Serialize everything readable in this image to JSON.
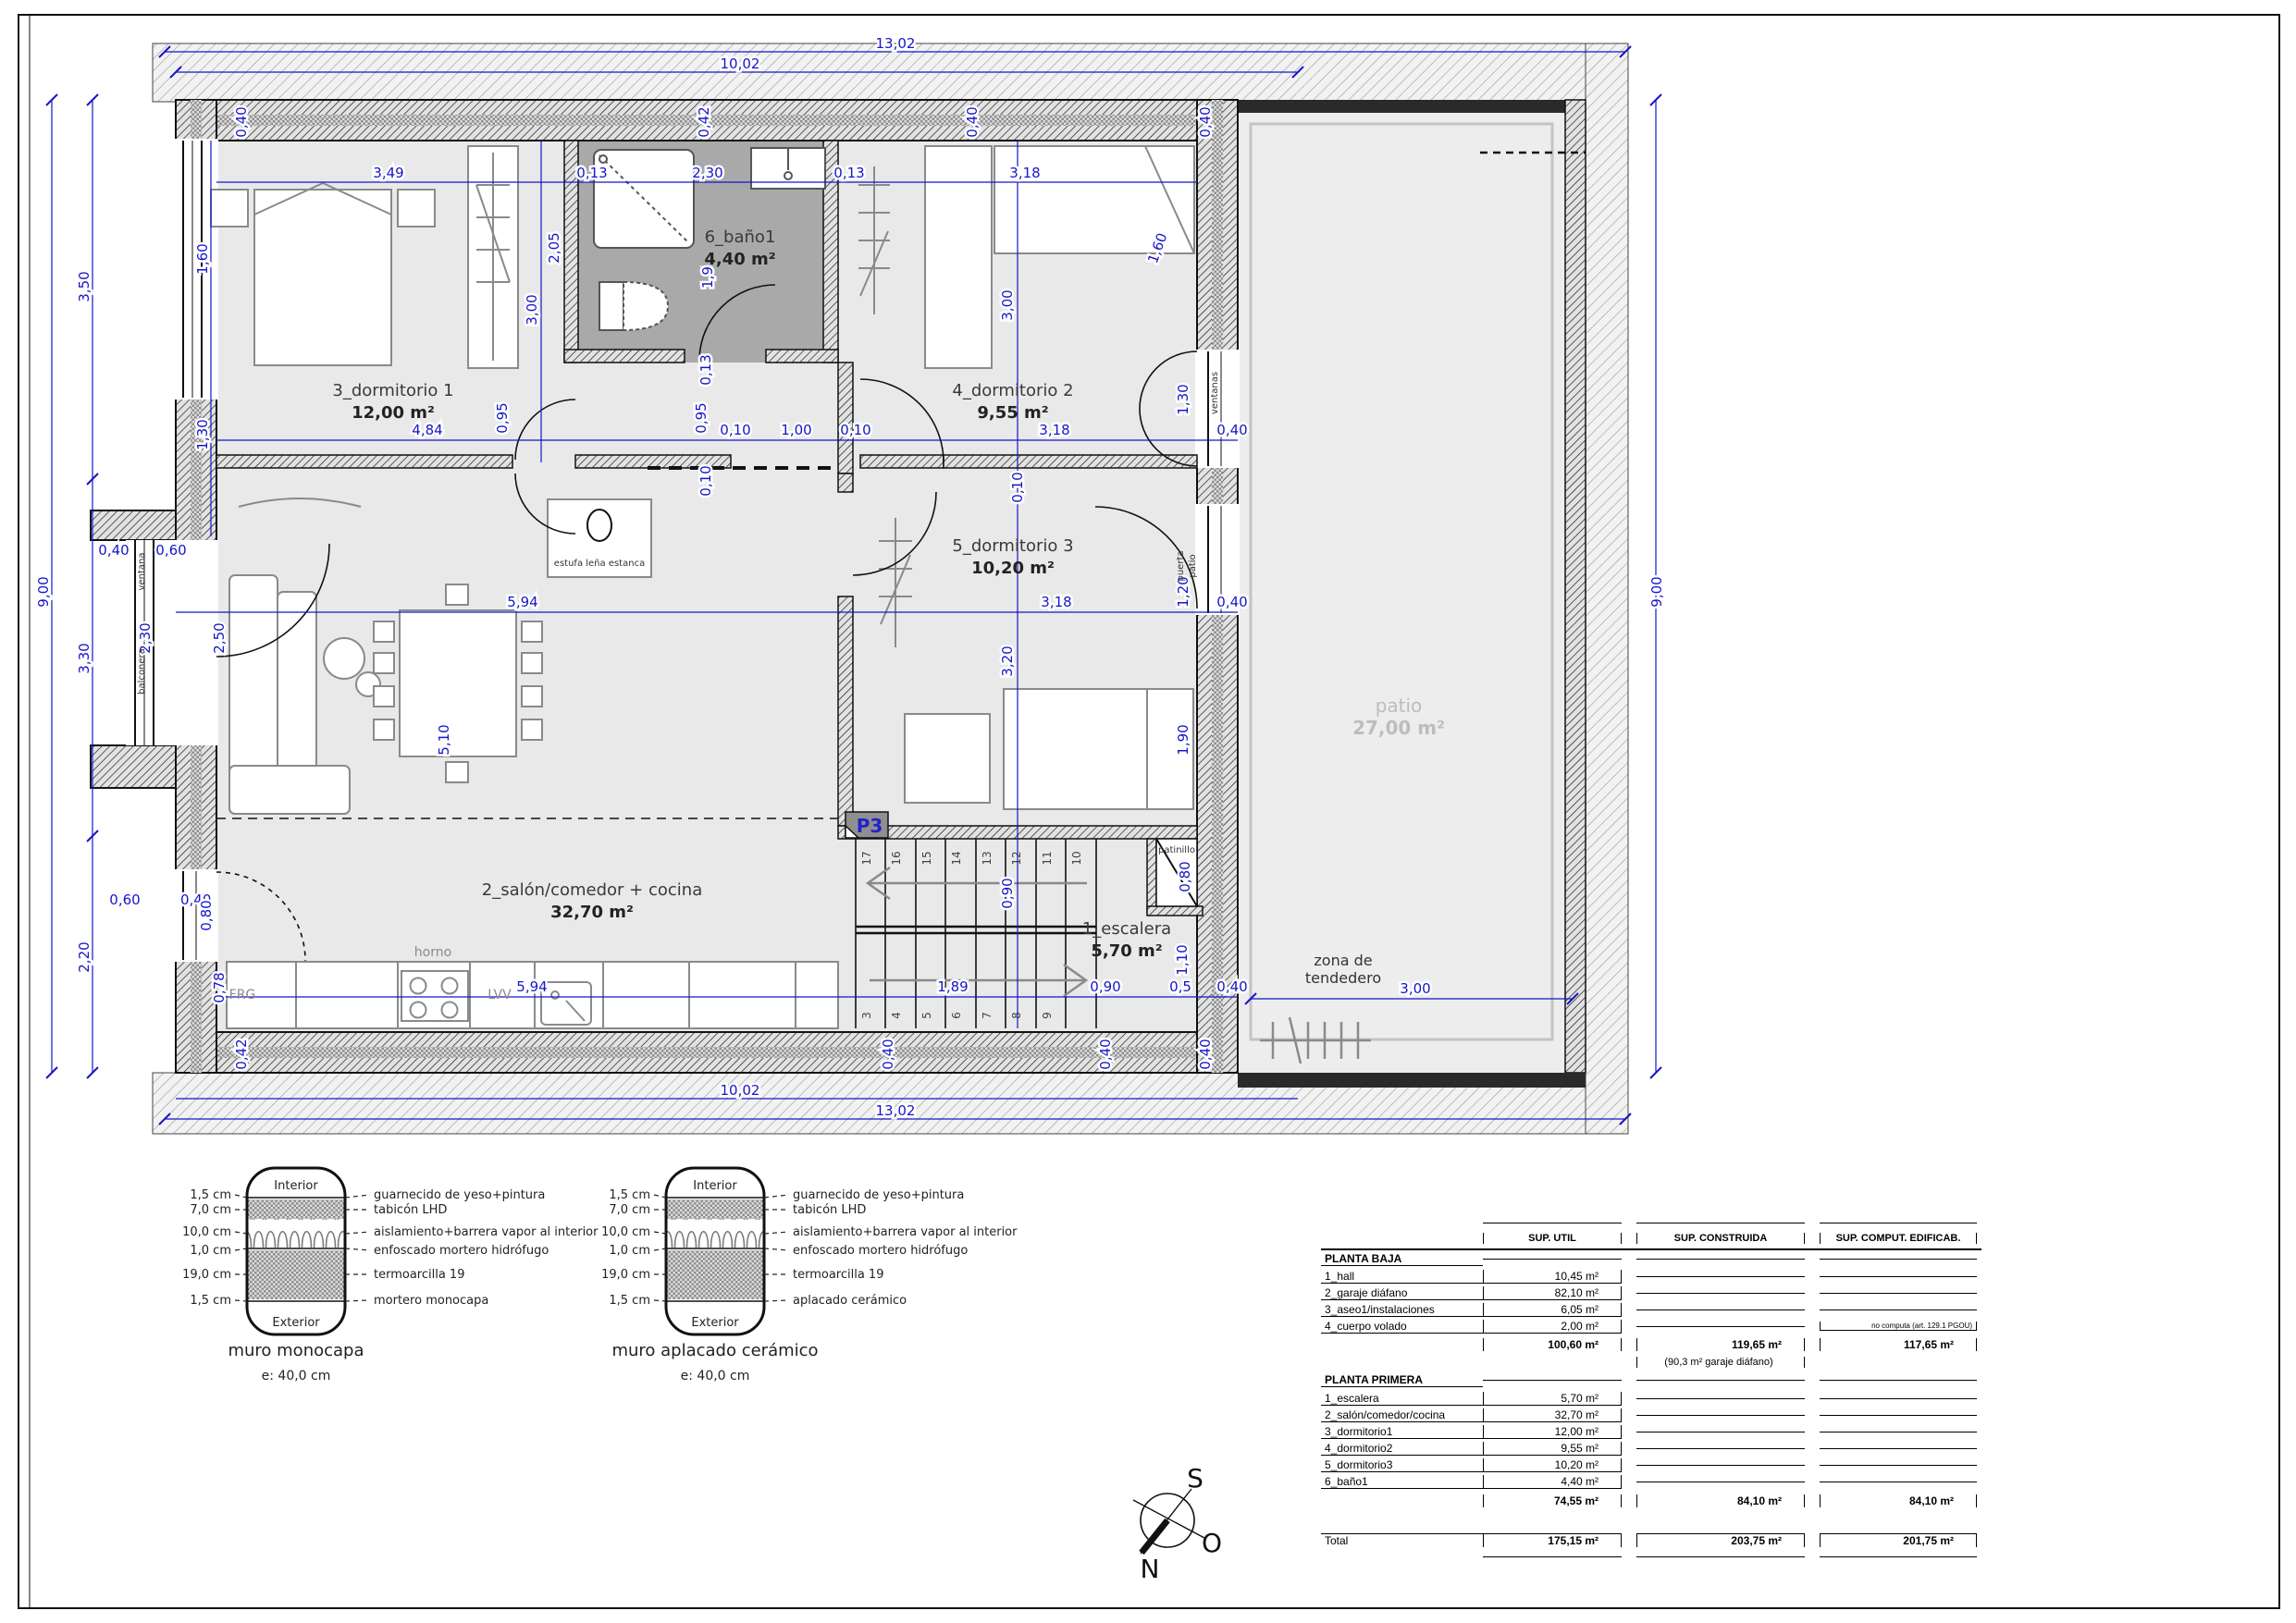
{
  "plan": {
    "rooms": [
      {
        "name": "3_dormitorio 1",
        "area": "12,00 m²"
      },
      {
        "name": "4_dormitorio 2",
        "area": "9,55 m²"
      },
      {
        "name": "5_dormitorio 3",
        "area": "10,20 m²"
      },
      {
        "name": "6_baño1",
        "area": "4,40 m²"
      },
      {
        "name": "2_salón/comedor + cocina",
        "area": "32,70 m²"
      },
      {
        "name": "1_escalera",
        "area": "5,70 m²"
      },
      {
        "name": "patio",
        "area": "27,00 m²"
      }
    ],
    "ann": {
      "patinillo": "patinillo",
      "zona1": "zona de",
      "zona2": "tendedero",
      "estufa": "estufa leña estanca",
      "horno": "horno",
      "lvv": "LVV",
      "frg": "FRG",
      "p3": "P3",
      "ventanas": "ventanas",
      "puerta1": "puerta",
      "puerta2": "patio",
      "balconera": "balconera",
      "ventana": "ventana"
    },
    "stairs": [
      "17",
      "16",
      "15",
      "14",
      "13",
      "12",
      "11",
      "10",
      "3",
      "4",
      "5",
      "6",
      "7",
      "8",
      "9"
    ],
    "dims": [
      "13,02",
      "10,02",
      "13,02",
      "10,02",
      "9,00",
      "9,00",
      "3,50",
      "3,30",
      "2,20",
      "3,49",
      "2,30",
      "3,18",
      "0,42",
      "0,40",
      "0,40",
      "0,40",
      "1,60",
      "1,60",
      "2,05",
      "3,00",
      "3,00",
      "1,9",
      "0,13",
      "0,13",
      "0,13",
      "1,30",
      "1,30",
      "0,95",
      "0,95",
      "4,84",
      "3,18",
      "0,40",
      "0,10",
      "1,00",
      "0,10",
      "5,94",
      "3,18",
      "1,20",
      "0,40",
      "0,10",
      "2,30",
      "2,50",
      "5,10",
      "3,20",
      "1,90",
      "0,60",
      "0,40",
      "0,40",
      "0,60",
      "0,80",
      "0,78",
      "5,94",
      "1,89",
      "0,90",
      "0,5",
      "0,40",
      "0,90",
      "0,80",
      "1,10",
      "3,00",
      "0,42",
      "0,40",
      "0,40",
      "0,40",
      "0,10"
    ]
  },
  "wall_details": [
    {
      "title": "muro monocapa",
      "scale": "e: 40,0 cm",
      "top_label": "Interior",
      "bottom_label": "Exterior",
      "layers": [
        {
          "size": "1,5 cm",
          "desc": "guarnecido de yeso+pintura"
        },
        {
          "size": "7,0 cm",
          "desc": "tabicón LHD"
        },
        {
          "size": "10,0 cm",
          "desc": "aislamiento+barrera vapor al interior"
        },
        {
          "size": "1,0 cm",
          "desc": "enfoscado mortero hidrófugo"
        },
        {
          "size": "19,0 cm",
          "desc": "termoarcilla 19"
        },
        {
          "size": "1,5 cm",
          "desc": "mortero monocapa"
        }
      ]
    },
    {
      "title": "muro aplacado cerámico",
      "scale": "e: 40,0 cm",
      "top_label": "Interior",
      "bottom_label": "Exterior",
      "layers": [
        {
          "size": "1,5 cm",
          "desc": "guarnecido de yeso+pintura"
        },
        {
          "size": "7,0 cm",
          "desc": "tabicón LHD"
        },
        {
          "size": "10,0 cm",
          "desc": "aislamiento+barrera vapor al interior"
        },
        {
          "size": "1,0 cm",
          "desc": "enfoscado mortero hidrófugo"
        },
        {
          "size": "19,0 cm",
          "desc": "termoarcilla 19"
        },
        {
          "size": "1,5 cm",
          "desc": "aplacado cerámico"
        }
      ]
    }
  ],
  "compass": {
    "s": "S",
    "o": "O",
    "n": "N"
  },
  "areas_table": {
    "col_headers": [
      "SUP. UTIL",
      "SUP. CONSTRUIDA",
      "SUP. COMPUT. EDIFICAB."
    ],
    "planta_baja": {
      "title": "PLANTA BAJA",
      "rows": [
        {
          "label": "1_hall",
          "util": "10,45 m²"
        },
        {
          "label": "2_garaje diáfano",
          "util": "82,10 m²"
        },
        {
          "label": "3_aseo1/instalaciones",
          "util": "6,05 m²"
        },
        {
          "label": "4_cuerpo volado",
          "util": "2,00 m²",
          "note": "no computa (art. 129.1 PGOU)"
        }
      ],
      "subtotal": {
        "util": "100,60 m²",
        "construida": "119,65 m²",
        "construida_note": "(90,3 m² garaje diáfano)",
        "edificab": "117,65 m²"
      }
    },
    "planta_primera": {
      "title": "PLANTA PRIMERA",
      "rows": [
        {
          "label": "1_escalera",
          "util": "5,70 m²"
        },
        {
          "label": "2_salón/comedor/cocina",
          "util": "32,70 m²"
        },
        {
          "label": "3_dormitorio1",
          "util": "12,00 m²"
        },
        {
          "label": "4_dormitorio2",
          "util": "9,55 m²"
        },
        {
          "label": "5_dormitorio3",
          "util": "10,20 m²"
        },
        {
          "label": "6_baño1",
          "util": "4,40 m²"
        }
      ],
      "subtotal": {
        "util": "74,55 m²",
        "construida": "84,10 m²",
        "edificab": "84,10 m²"
      }
    },
    "total": {
      "label": "Total",
      "util": "175,15 m²",
      "construida": "203,75 m²",
      "edificab": "201,75 m²"
    }
  }
}
